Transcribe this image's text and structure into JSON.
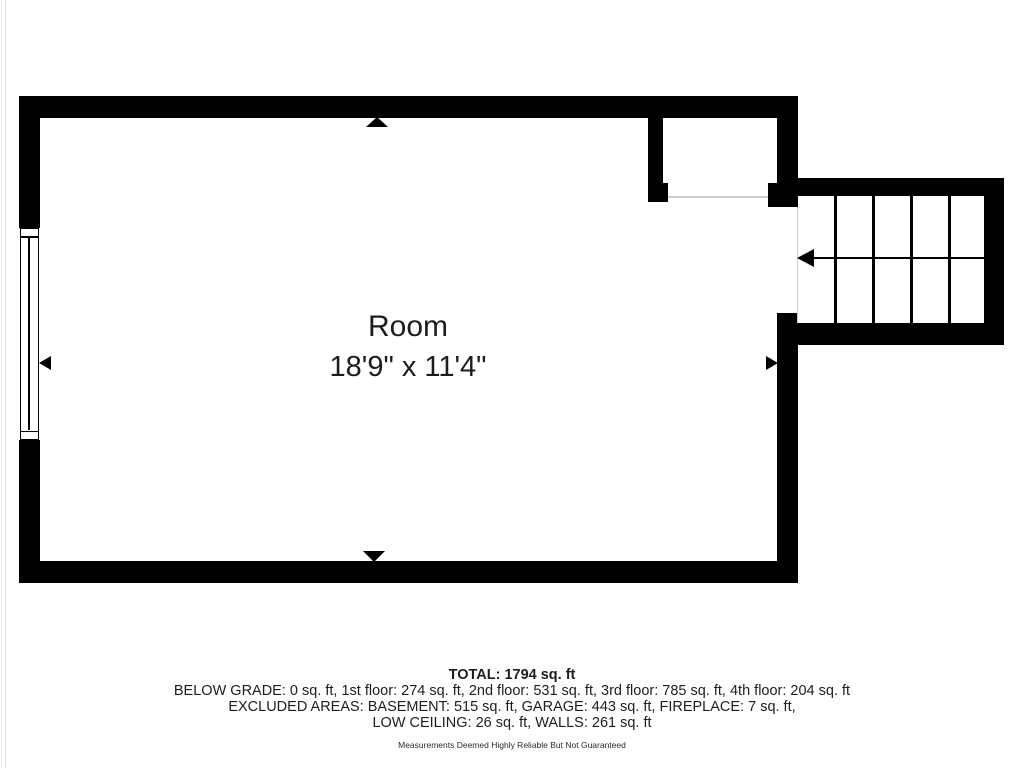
{
  "room": {
    "name": "Room",
    "dimensions": "18'9\" x 11'4\""
  },
  "summary": {
    "total": "TOTAL: 1794 sq. ft",
    "floors": "BELOW GRADE: 0 sq. ft, 1st floor: 274 sq. ft, 2nd floor: 531 sq. ft, 3rd floor: 785 sq. ft, 4th floor: 204 sq. ft",
    "excluded_line1": "EXCLUDED AREAS: BASEMENT: 515 sq. ft, GARAGE: 443 sq. ft, FIREPLACE: 7 sq. ft,",
    "excluded_line2": "LOW CEILING: 26 sq. ft, WALLS: 261 sq. ft",
    "disclaimer": "Measurements Deemed Highly Reliable But Not Guaranteed"
  },
  "stairs": {
    "tread_x": [
      834,
      872,
      910,
      948
    ],
    "walk_direction": "left"
  },
  "colors": {
    "wall": "#000000",
    "text": "#1d1d1d",
    "threshold": "#cccccc",
    "background": "#ffffff"
  }
}
